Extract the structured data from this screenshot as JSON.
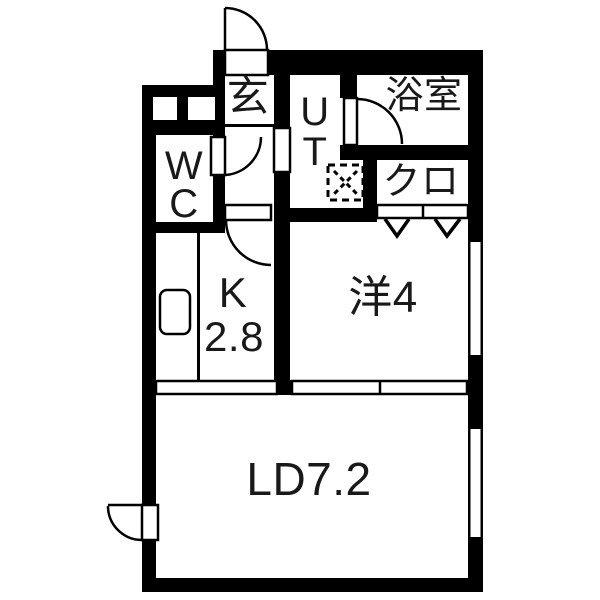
{
  "rooms": {
    "genkan": {
      "label": "玄"
    },
    "wc": {
      "line1": "W",
      "line2": "C"
    },
    "ut": {
      "line1": "U",
      "line2": "T"
    },
    "bathroom": {
      "label": "浴室"
    },
    "closet": {
      "label": "クロ"
    },
    "kitchen": {
      "label": "K",
      "size": "2.8"
    },
    "western_room": {
      "label": "洋4"
    },
    "living_dining": {
      "label": "LD7.2"
    }
  },
  "symbols": {
    "door_swing": "quarter-circle-arc",
    "entrance_door": "quarter-circle-arc",
    "bifold_closet_door": "double-chevron",
    "washing_machine_space": "dashed-box-with-x",
    "kitchen_sink": "rounded-rectangle",
    "window": "white-gap-in-wall"
  },
  "colors": {
    "wall": "#000000",
    "floor": "#ffffff",
    "text": "#191919"
  }
}
